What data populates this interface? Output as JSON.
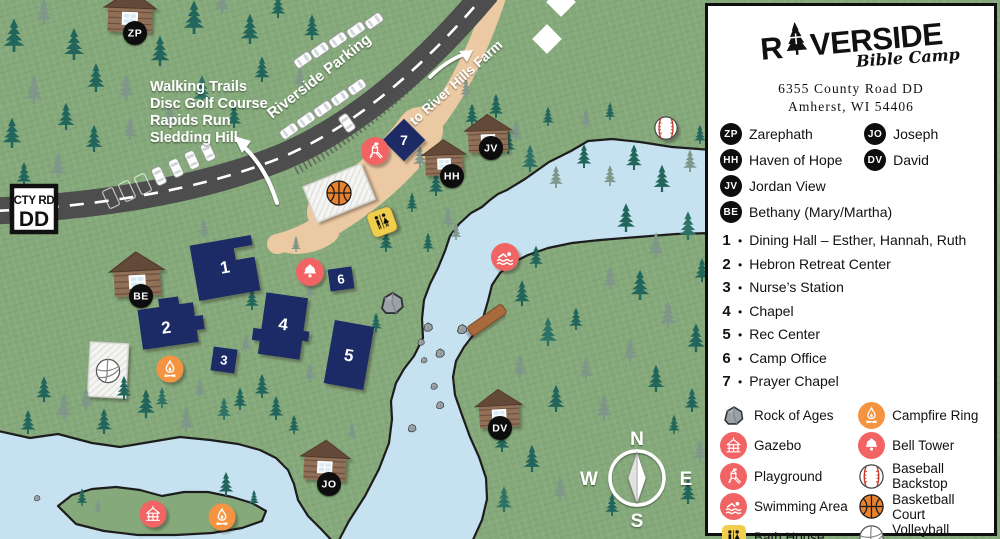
{
  "title": "Riverside Bible Camp Map",
  "colors": {
    "grass": "#85A97A",
    "water": "#C6E2F0",
    "road": "#4D4D4D",
    "sand": "#EBC9A2",
    "building_navy": "#1C2A66",
    "accent_red": "#F26363",
    "accent_orange": "#F49441",
    "bath_yellow": "#F0CE4E",
    "badge_black": "#0D0D0D"
  },
  "panel": {
    "logo": {
      "prefix": "R",
      "suffix": "VERSIDE",
      "subtitle": "Bible Camp"
    },
    "address1": "6355 County Road DD",
    "address2": "Amherst, WI 54406",
    "cabins": [
      {
        "code": "ZP",
        "name": "Zarephath"
      },
      {
        "code": "JO",
        "name": "Joseph"
      },
      {
        "code": "HH",
        "name": "Haven of Hope"
      },
      {
        "code": "DV",
        "name": "David"
      },
      {
        "code": "JV",
        "name": "Jordan View"
      },
      {
        "code": "BE",
        "name": "Bethany (Mary/Martha)"
      }
    ],
    "bullet": "•",
    "numbered": [
      {
        "num": "1",
        "label": "Dining Hall – Esther, Hannah, Ruth"
      },
      {
        "num": "2",
        "label": "Hebron Retreat Center"
      },
      {
        "num": "3",
        "label": "Nurse’s Station"
      },
      {
        "num": "4",
        "label": "Chapel"
      },
      {
        "num": "5",
        "label": "Rec Center"
      },
      {
        "num": "6",
        "label": "Camp Office"
      },
      {
        "num": "7",
        "label": "Prayer Chapel"
      }
    ],
    "features_left": [
      {
        "icon": "rock",
        "label": "Rock of Ages"
      },
      {
        "icon": "gazebo",
        "label": "Gazebo"
      },
      {
        "icon": "playground",
        "label": "Playground"
      },
      {
        "icon": "swimming",
        "label": "Swimming Area"
      },
      {
        "icon": "bath-house",
        "label": "Bath House"
      }
    ],
    "features_right": [
      {
        "icon": "campfire",
        "label": "Campfire Ring"
      },
      {
        "icon": "bell",
        "label": "Bell Tower"
      },
      {
        "icon": "baseball",
        "label": "Baseball Backstop"
      },
      {
        "icon": "basketball",
        "label": "Basketball Court"
      },
      {
        "icon": "volleyball",
        "label": "Volleyball Court"
      }
    ]
  },
  "map": {
    "road_sign": {
      "line1": "CTY RD",
      "line2": "DD"
    },
    "trails": [
      "Walking Trails",
      "Disc Golf Course",
      "Rapids Run",
      "Sledding Hill"
    ],
    "parking_label": "Riverside Parking",
    "farm_label": "to River Hills Farm",
    "compass": {
      "n": "N",
      "e": "E",
      "s": "S",
      "w": "W"
    },
    "building_numbers": [
      "1",
      "2",
      "3",
      "4",
      "5",
      "6",
      "7"
    ],
    "cabin_badges": [
      "ZP",
      "BE",
      "HH",
      "JV",
      "DV",
      "JO"
    ]
  }
}
